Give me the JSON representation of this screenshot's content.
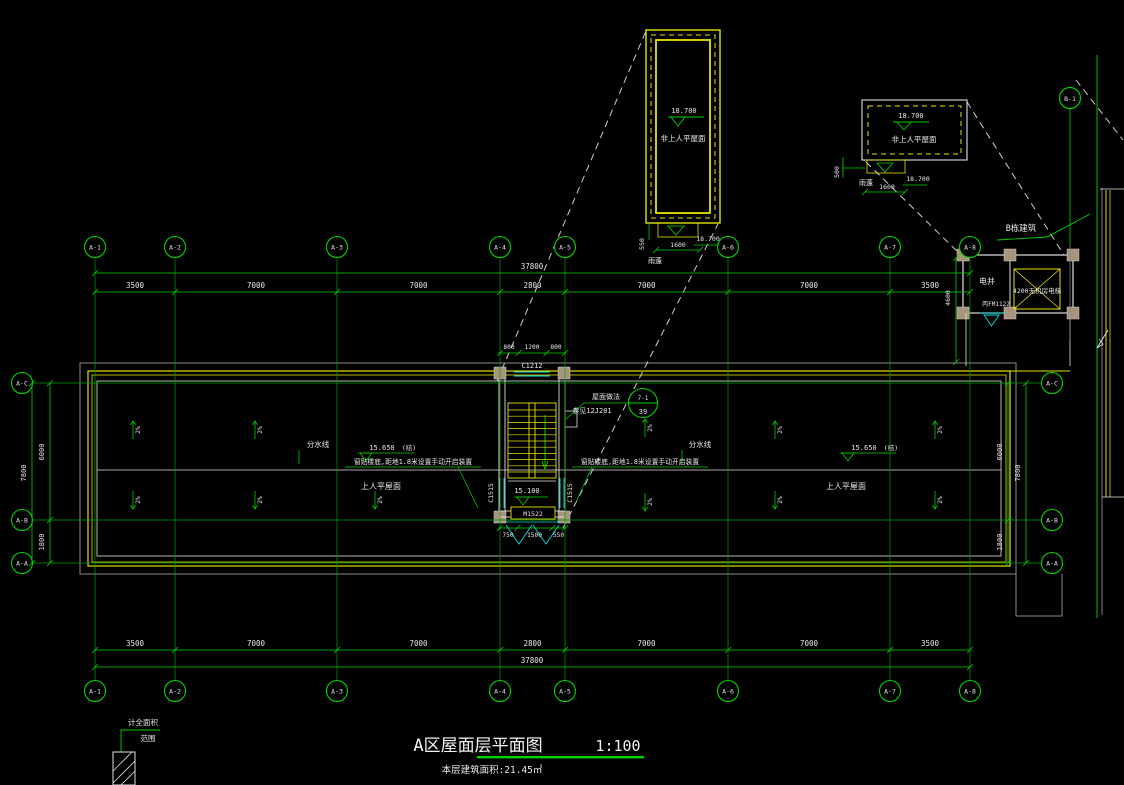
{
  "drawing": {
    "title": "A区屋面层平面图",
    "scale": "1:100",
    "subtitle": "本层建筑面积:21.45㎡"
  },
  "legend": {
    "line1": "计全面积",
    "line2": "范围"
  },
  "axis": {
    "h": [
      "A-1",
      "A-2",
      "A-3",
      "A-4",
      "A-5",
      "A-6",
      "A-7",
      "A-8"
    ],
    "v": [
      "A-C",
      "A-B",
      "A-A"
    ],
    "b1": "B-1"
  },
  "dims": {
    "total": "37800",
    "seg": [
      "3500",
      "7000",
      "7000",
      "2800",
      "7000",
      "7000",
      "3500"
    ],
    "left_total": "7800",
    "left_upper": "6000",
    "left_lower": "1800",
    "right_total": "7800",
    "right_upper": "6000",
    "right_lower": "1800",
    "elev_shaft": "4600",
    "stair_top": [
      "800",
      "1200",
      "800"
    ],
    "stair_bottom": [
      "750",
      "1500",
      "550"
    ]
  },
  "roof": {
    "divide_line": "分水线",
    "elev": "15.650",
    "elev_suffix": "(结)",
    "surface": "上人平屋面",
    "slope": "2%",
    "window_note": "窗贴楼底,距地1.8米设置手动开启装置"
  },
  "stair": {
    "window_top": "C1212",
    "window_side": "C1515",
    "door": "M1522",
    "elev": "15.100",
    "note1": "屋面做法",
    "note2": "参见12J201",
    "detail_top": "7-1",
    "detail_bottom": "39"
  },
  "elevator": {
    "shaft": "电井",
    "door": "丙FM1122",
    "label": "4200无机房电梯",
    "building": "B栋建筑"
  },
  "detail": {
    "elev": "18.700",
    "label": "非上人平屋面",
    "canopy": "雨蓬",
    "w": "1600",
    "h1": "550",
    "h2": "500"
  }
}
